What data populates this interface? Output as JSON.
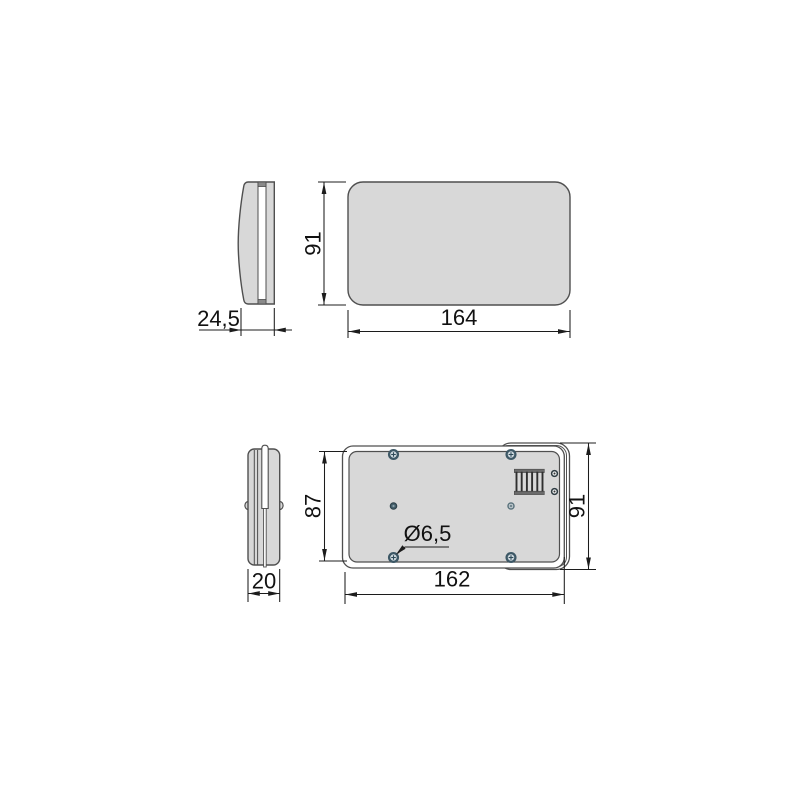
{
  "drawing": {
    "colors": {
      "background": "#ffffff",
      "object_outline": "#4f4f4f",
      "object_fill": "#d8d8d8",
      "dimension_lines": "#1c1c1c",
      "screw_ring": "#3d5866"
    },
    "dimensions": {
      "side_depth": "24,5",
      "front_height": "91",
      "front_width": "164",
      "base_depth": "20",
      "back_inner_height": "87",
      "back_outer_height": "91",
      "back_width": "162",
      "hole_diameter": "Ø6,5"
    }
  }
}
